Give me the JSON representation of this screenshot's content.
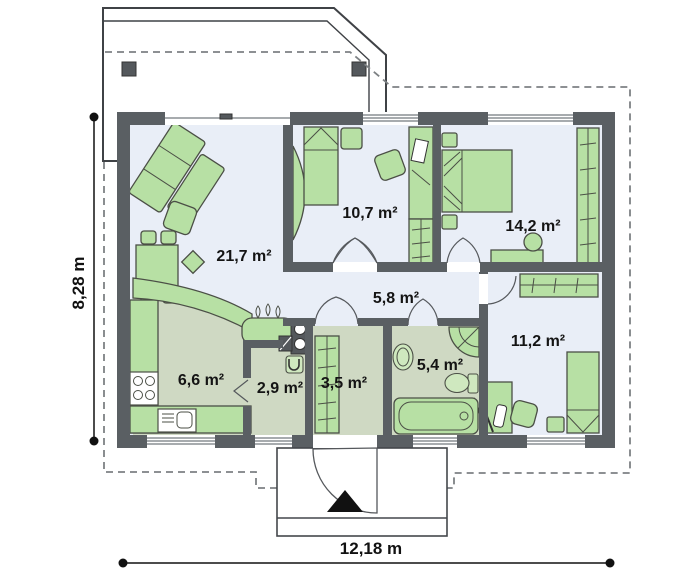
{
  "plan": {
    "title_hint": "single-storey house floor plan",
    "rooms": [
      {
        "id": "living-room",
        "area": "21,7 m²"
      },
      {
        "id": "bedroom-1",
        "area": "10,7 m²"
      },
      {
        "id": "bedroom-2",
        "area": "14,2 m²"
      },
      {
        "id": "hall",
        "area": "5,8 m²"
      },
      {
        "id": "bedroom-3",
        "area": "11,2 m²"
      },
      {
        "id": "kitchen",
        "area": "6,6 m²"
      },
      {
        "id": "utility",
        "area": "2,9 m²"
      },
      {
        "id": "corridor",
        "area": "3,5 m²"
      },
      {
        "id": "bathroom",
        "area": "5,4 m²"
      }
    ],
    "dimensions": {
      "width": "12,18 m",
      "height": "8,28 m"
    },
    "colors": {
      "wall": "#5a5f63",
      "floor_blue": "#e9eef7",
      "floor_green": "#cfd9c3",
      "furniture": "#b7e0a4",
      "furniture_outline": "#4b4f46",
      "dashed_overhang": "#7d8184"
    }
  }
}
